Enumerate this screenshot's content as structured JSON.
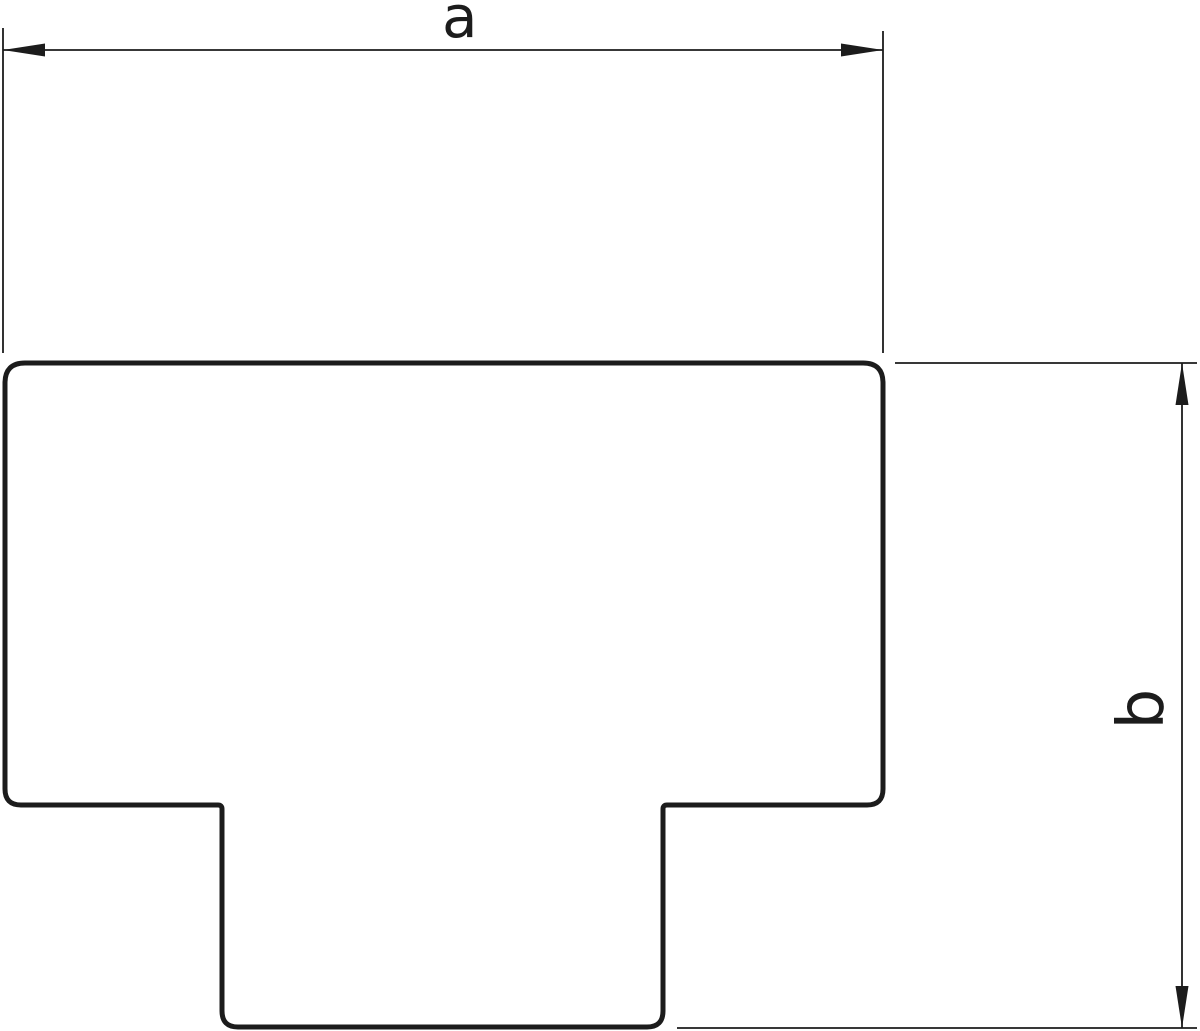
{
  "drawing": {
    "kind": "technical-outline-drawing",
    "shape": "t-piece-cover",
    "background_color": "#ffffff",
    "line_color": "#1c1c1c",
    "outline_fill_color": "#ffffff",
    "dimension_a": {
      "label": "a",
      "orientation": "horizontal",
      "position": "top",
      "measures": "overall width of top section"
    },
    "dimension_b": {
      "label": "b",
      "orientation": "vertical",
      "position": "right",
      "measures": "overall height of shape"
    }
  }
}
